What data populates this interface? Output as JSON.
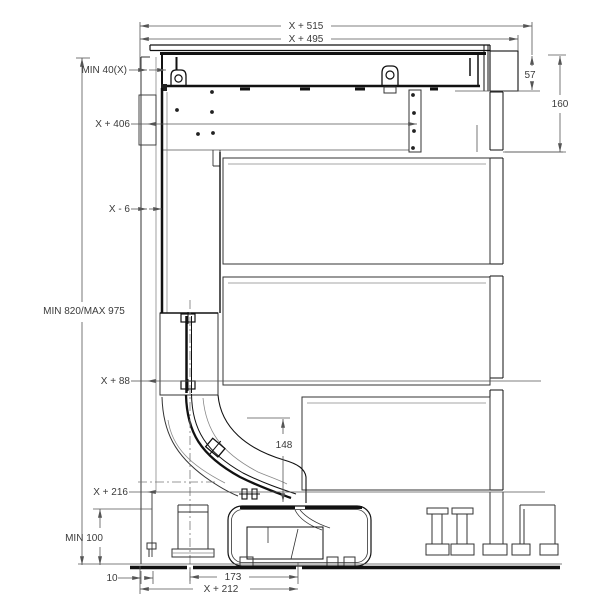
{
  "drawing": {
    "type": "appliance installation cross-section diagram",
    "colors": {
      "background": "#ffffff",
      "structure": "#111111",
      "dimension_lines": "#555555",
      "label_text": "#3b3b3b"
    },
    "dims": {
      "x515": "X + 515",
      "x495": "X + 495",
      "min40": "MIN 40(X)",
      "d57": "57",
      "d160": "160",
      "x406": "X + 406",
      "xm6": "X - 6",
      "min820": "MIN 820/MAX 975",
      "x88": "X + 88",
      "d148": "148",
      "x216": "X + 216",
      "min100": "MIN 100",
      "d10": "10",
      "d173": "173",
      "x212": "X + 212"
    }
  }
}
